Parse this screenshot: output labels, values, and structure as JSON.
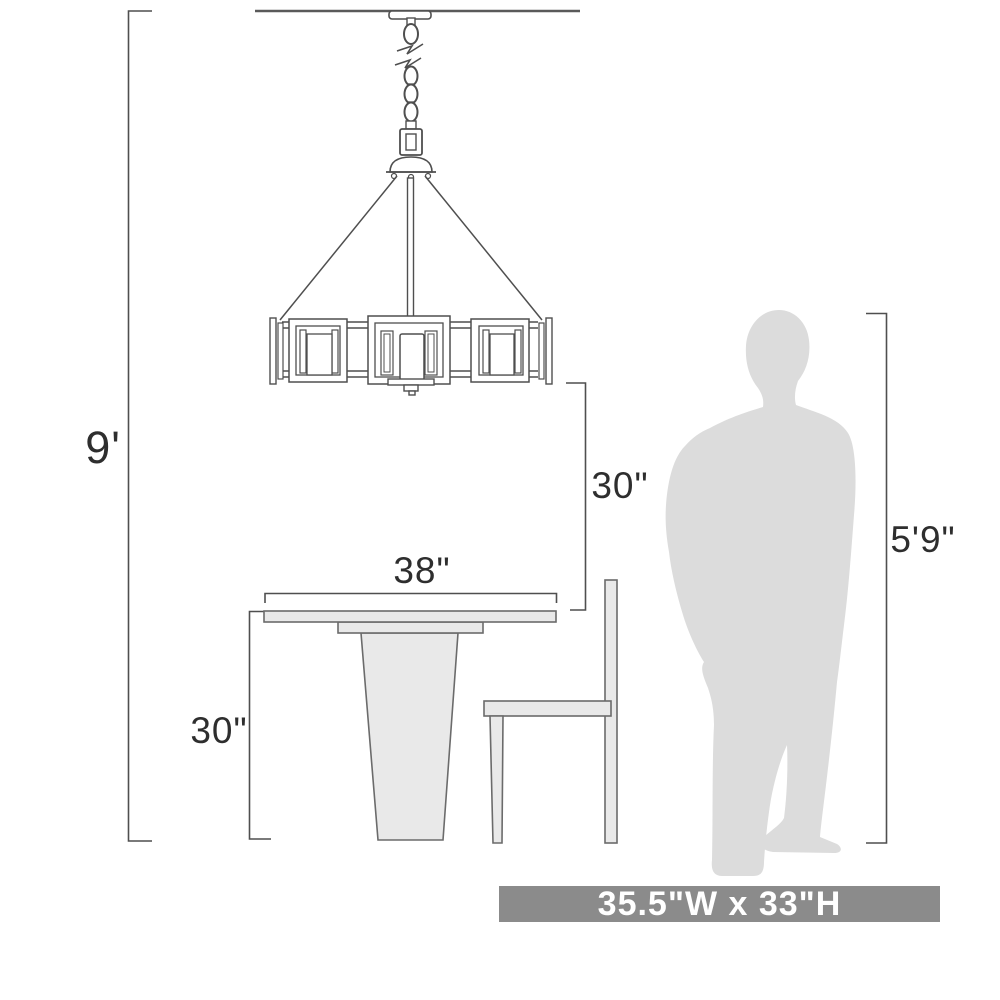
{
  "diagram": {
    "type": "product-dimension-diagram",
    "product": "chandelier-over-dining-table",
    "labels": {
      "ceiling_height": "9'",
      "fixture_to_table_clearance": "30\"",
      "table_width": "38\"",
      "table_height": "30\"",
      "person_height": "5'9\"",
      "fixture_size": "35.5\"W x 33\"H"
    },
    "colors": {
      "line": "#4f4f4f",
      "furniture_fill": "#e9e9e9",
      "furniture_stroke": "#6b6b6b",
      "silhouette": "#dcdcdc",
      "banner_bg": "#8b8b8b",
      "banner_text": "#ffffff",
      "label_text": "#2e2e2e"
    }
  }
}
